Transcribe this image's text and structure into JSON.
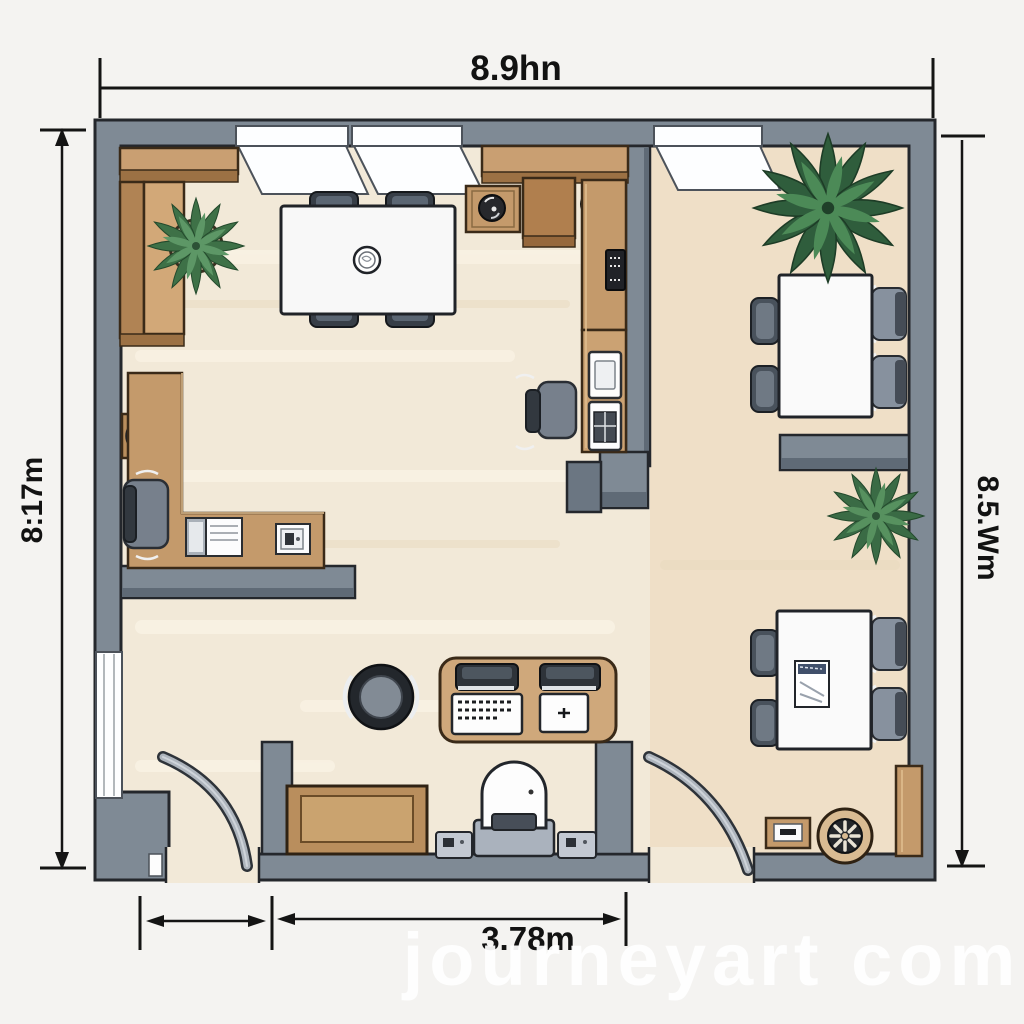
{
  "title": "Office floor plan",
  "dimensions": {
    "top_label": "8.9hn",
    "left_label": "8:17m",
    "right_label": "8.5.Wm",
    "bottom_label": "3.78m"
  },
  "watermark": "journeyart com",
  "palette": {
    "wall_gray": "#7f8a95",
    "wall_shadow": "#5f6a76",
    "outline_dark": "#24272c",
    "floor_cream": "#f2e9d8",
    "floor_tan": "#ecd7ba",
    "wood_mid": "#c49a6b",
    "wood_light": "#d2a878",
    "wood_dark": "#b07f4e",
    "surface_white": "#fafafa",
    "chair_slate": "#49525c",
    "chair_gray": "#87919e",
    "plant_dark_green": "#2f5d3c",
    "plant_green": "#4e8a58"
  },
  "furniture": [
    "sofa-bench",
    "potted-plant",
    "dining-table",
    "dining-chairs",
    "storage-shelf",
    "kitchen-counter",
    "coffee-machine",
    "printer",
    "mini-fridge",
    "office-chairs",
    "l-shaped-desk",
    "gauge-clock",
    "laptop",
    "reception-desk",
    "round-stool",
    "keyboard",
    "mouse-pad",
    "wooden-bench",
    "weighing-chair",
    "table-fan",
    "storage-cabinet",
    "meeting-tables",
    "document-paper",
    "palm-plants",
    "swing-doors",
    "windows"
  ]
}
